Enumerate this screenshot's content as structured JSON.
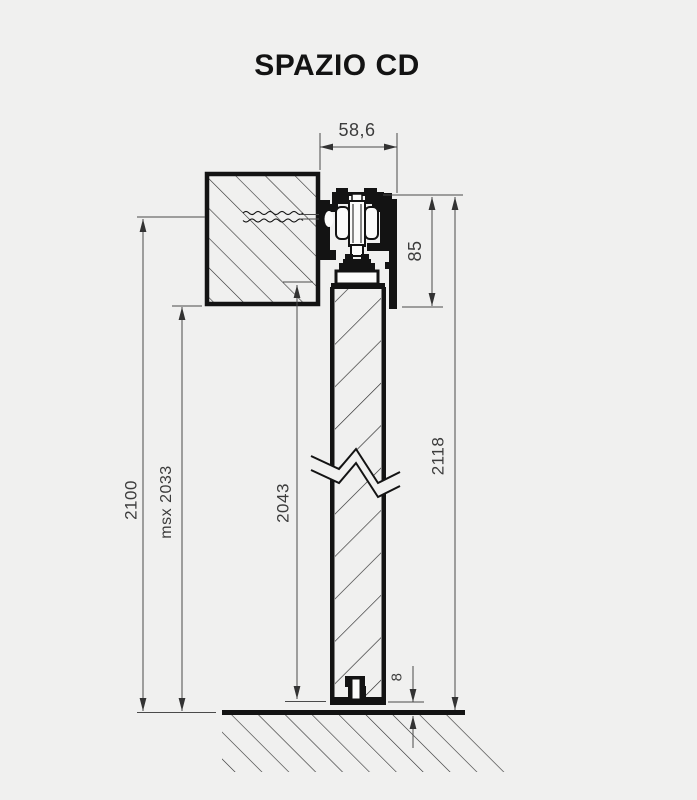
{
  "title": "SPAZIO CD",
  "colors": {
    "background": "#f0f0ef",
    "drawing_line": "#131313",
    "dimension_line": "#4a4a4a",
    "dimension_text": "#3c3c3c"
  },
  "drawing": {
    "type": "technical-section",
    "description": "Vertical cross-section of the SPAZIO CD sliding door system: wall-fixed track with roller carriage, hanging door panel with break symbol, and floor guide with 8 mm gap",
    "dimensions": [
      {
        "id": "track_width",
        "label": "58,6",
        "orientation": "horizontal"
      },
      {
        "id": "track_height",
        "label": "85",
        "orientation": "vertical"
      },
      {
        "id": "overall_height",
        "label": "2118",
        "orientation": "vertical"
      },
      {
        "id": "left_height",
        "label": "2100",
        "orientation": "vertical"
      },
      {
        "id": "max_passage",
        "label": "msx 2033",
        "orientation": "vertical"
      },
      {
        "id": "door_height",
        "label": "2043",
        "orientation": "vertical"
      },
      {
        "id": "floor_gap",
        "label": "8",
        "orientation": "vertical"
      }
    ]
  }
}
